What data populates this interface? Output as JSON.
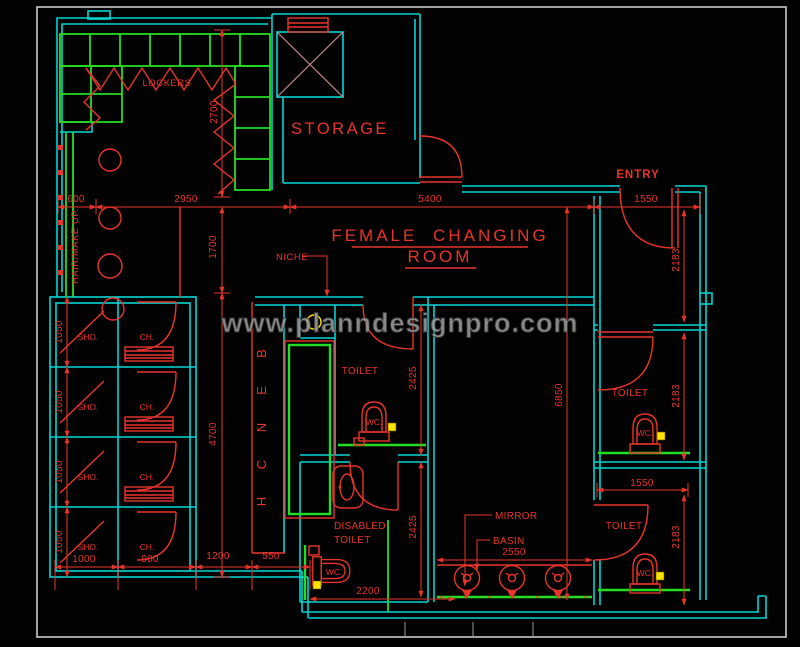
{
  "watermark": "www.planndesignpro.com",
  "title": {
    "line1": "FEMALE CHANGING",
    "line2": "ROOM"
  },
  "labels": {
    "lockers": "LOCKERS",
    "storage": "STORAGE",
    "entry": "ENTRY",
    "niche": "NICHE",
    "hair_make_up": "HAIR/MAKE UP.",
    "toilet": "TOILET",
    "disabled_line1": "DISABLED",
    "disabled_line2": "TOILET",
    "mirror": "MIRROR",
    "basin": "BASIN",
    "wc": "WC.",
    "shower": "SHO.",
    "changing": "CH."
  },
  "bench_letters": [
    "B",
    "E",
    "N",
    "C",
    "H"
  ],
  "dimensions": {
    "d600": "600",
    "d2950": "2950",
    "d5400": "5400",
    "d1550": "1550",
    "d2700": "2700",
    "d1700": "1700",
    "d4700": "4700",
    "d6850": "6850",
    "d2183": "2183",
    "d2425": "2425",
    "d2550": "2550",
    "d2200": "2200",
    "d1050": "1050",
    "d1000": "1000",
    "d900": "900",
    "d1200": "1200",
    "d550": "550"
  },
  "colors": {
    "background": "#020202",
    "wall": "#00d6d6",
    "fixture": "#e8352b",
    "locker": "#23dd23",
    "accent": "#ffe400",
    "hatch": "#c98f8f",
    "watermark": "#9b9b9b",
    "frame": "#d8d8d8"
  }
}
